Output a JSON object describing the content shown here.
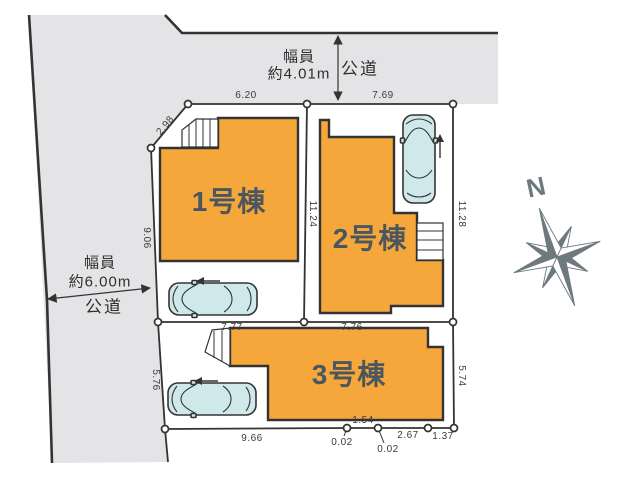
{
  "roads": {
    "top": {
      "width_line1": "幅員",
      "width_line2": "約4.01m",
      "category": "公道"
    },
    "left": {
      "width_line1": "幅員",
      "width_line2": "約6.00m",
      "category": "公道"
    }
  },
  "buildings": [
    {
      "label": "1号棟"
    },
    {
      "label": "2号棟"
    },
    {
      "label": "3号棟"
    }
  ],
  "compass": {
    "label": "N"
  },
  "dimensions": {
    "lot_top_left": "6.20",
    "lot_top_right": "7.69",
    "upper_left_diagonal": "2.98",
    "left_upper": "9.06",
    "divider_lot1_lot2": "11.24",
    "right_upper": "11.28",
    "mid_left": "7.77",
    "mid_right": "7.76",
    "left_lower": "5.76",
    "right_lower": "5.74",
    "bottom_main": "9.66",
    "bottom_notch_left": "0.02",
    "bottom_step": "1.54",
    "bottom_notch_right": "0.02",
    "bottom_right_mid": "2.67",
    "bottom_right_end": "1.37"
  },
  "colors": {
    "building_fill": "#F6A73C",
    "road_fill": "#E4E4E6",
    "car_fill": "#CFE9EA",
    "line": "#333333",
    "compass": "#6E797E",
    "building_label": "#4B565E",
    "dimension_text": "#3B3B3B"
  }
}
